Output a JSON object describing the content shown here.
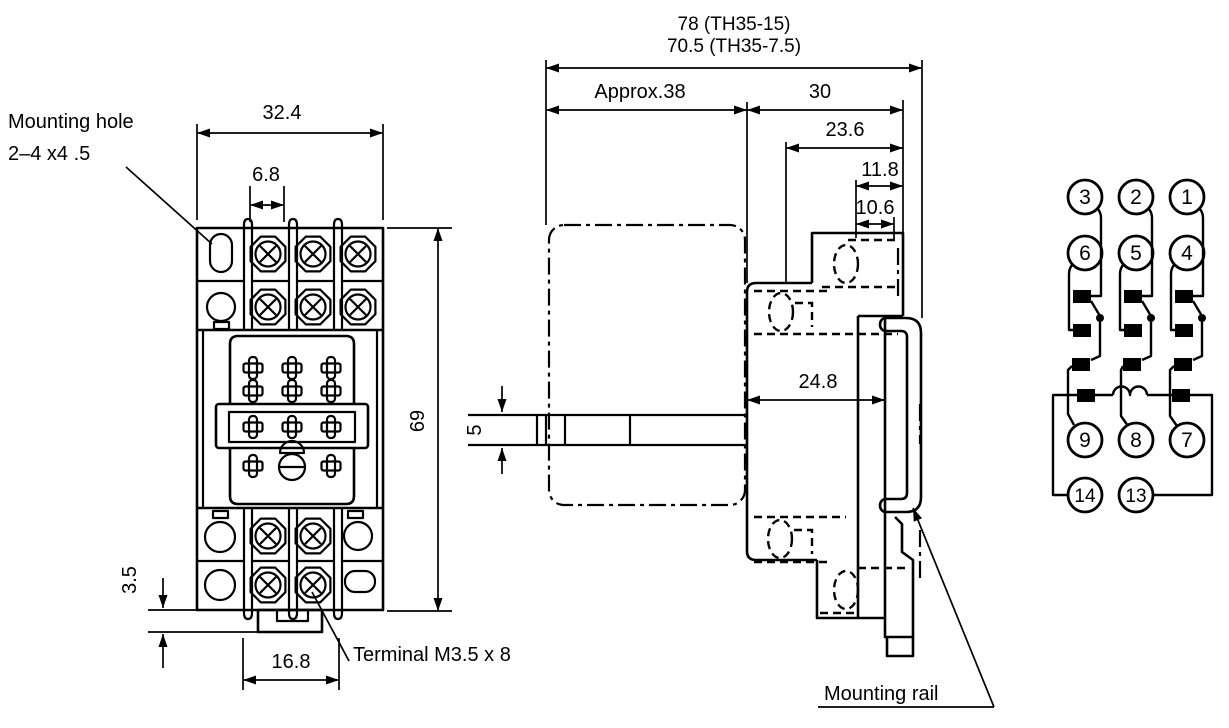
{
  "drawing": {
    "front_view": {
      "labels": {
        "mounting_hole_1": "Mounting hole",
        "mounting_hole_2": "2–4 x4 .5",
        "terminal": "Terminal M3.5 x 8"
      },
      "dims": {
        "width": "32.4",
        "pitch": "6.8",
        "height": "69",
        "bottom_offset": "3.5",
        "tab_width": "16.8"
      }
    },
    "side_view": {
      "dims": {
        "overall_th35_15": "78 (TH35-15)",
        "overall_th35_75": "70.5 (TH35-7.5)",
        "relay_depth": "Approx.38",
        "socket_depth": "30",
        "upper_a": "23.6",
        "upper_b": "11.8",
        "upper_c": "10.6",
        "inner_width": "24.8",
        "plate_thickness": "5"
      },
      "labels": {
        "rail": "Mounting rail"
      }
    },
    "pin_diagram": {
      "pins": [
        "3",
        "2",
        "1",
        "6",
        "5",
        "4",
        "9",
        "8",
        "7",
        "14",
        "13"
      ]
    },
    "colors": {
      "line": "#000000",
      "background": "#ffffff"
    }
  }
}
